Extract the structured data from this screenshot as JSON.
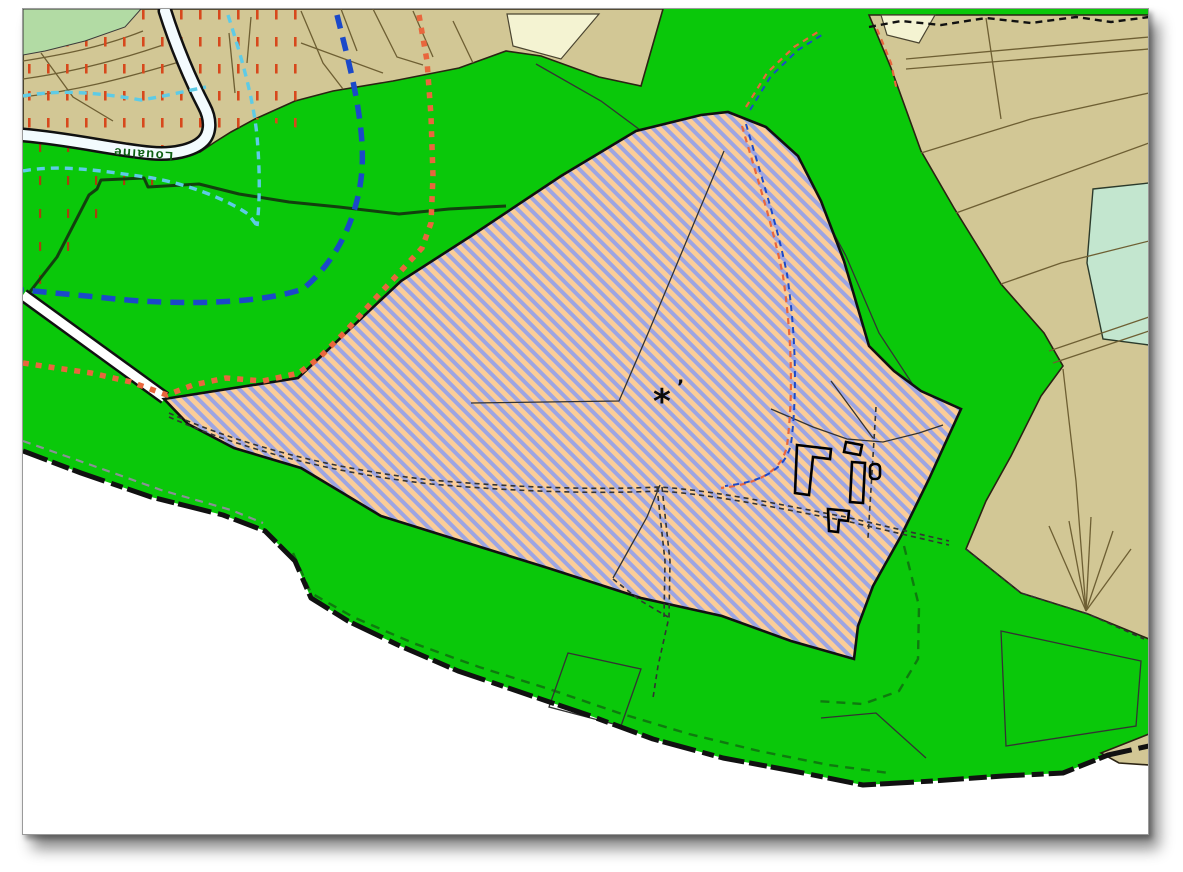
{
  "labels": {
    "stream": "Louaine",
    "marker": "*",
    "tick": "’"
  },
  "colors": {
    "page_bg": "#FFFFFF",
    "green": "#0AC80A",
    "tan": "#D2C795",
    "pale_green": "#B2DBA4",
    "pale_yellow": "#F4F3D2",
    "teal": "#C3E6CF",
    "hatch_orange": "#FBCD98",
    "hatch_stripe": "#9DA5E2",
    "stream_fill": "#F3FBFE",
    "red_dash_tan": "#D7481C",
    "red_dash_green": "#A8400E",
    "blue_dash": "#1B49C9",
    "cyan_dash": "#5ECBE6",
    "orange_dash": "#E9663D",
    "parcel_line": "#6E5F33",
    "outline_dark": "#111111",
    "wiggle_dark": "#12400E",
    "gray_dash": "#8A9096",
    "green_dash": "#0F7A0F",
    "label_green": "#0E5E12"
  },
  "features": {
    "main_zone": "green-natural-zone",
    "central_zone": "hatched-striped-zone",
    "left_overlay": "red-dash-hatched-overlay",
    "lines": [
      "blue-dashed-boundary",
      "cyan-dashed-boundary",
      "orange-dotted-boundary",
      "black-jagged-commune-boundary",
      "double-dashed-track"
    ],
    "water": "stream-band",
    "buildings": "black-building-footprints"
  }
}
